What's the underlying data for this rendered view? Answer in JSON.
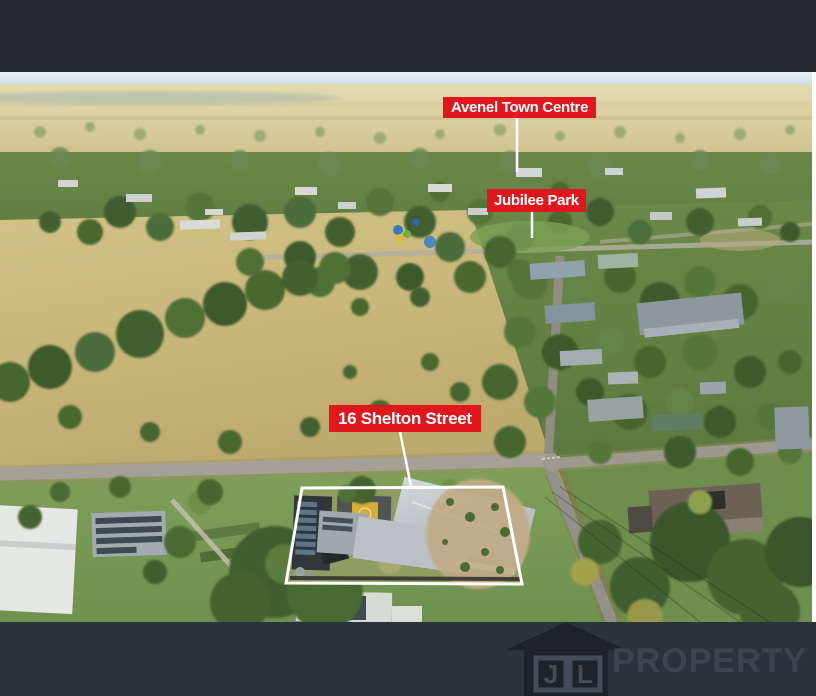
{
  "labels": {
    "town_centre": "Avenel Town Centre",
    "park": "Jubilee Park",
    "property": "16 Shelton Street"
  },
  "watermark": {
    "initial_j": "J",
    "initial_l": "L",
    "brand_name": "PROPERTY"
  },
  "colors": {
    "label_background": "#e2171e",
    "label_text": "#ffffff",
    "boundary_outline": "#ffffff",
    "top_bar": "#242a32",
    "bottom_bar": "#2a323b",
    "logo_silhouette": "#1c232b",
    "logo_text": "#3b4450"
  }
}
